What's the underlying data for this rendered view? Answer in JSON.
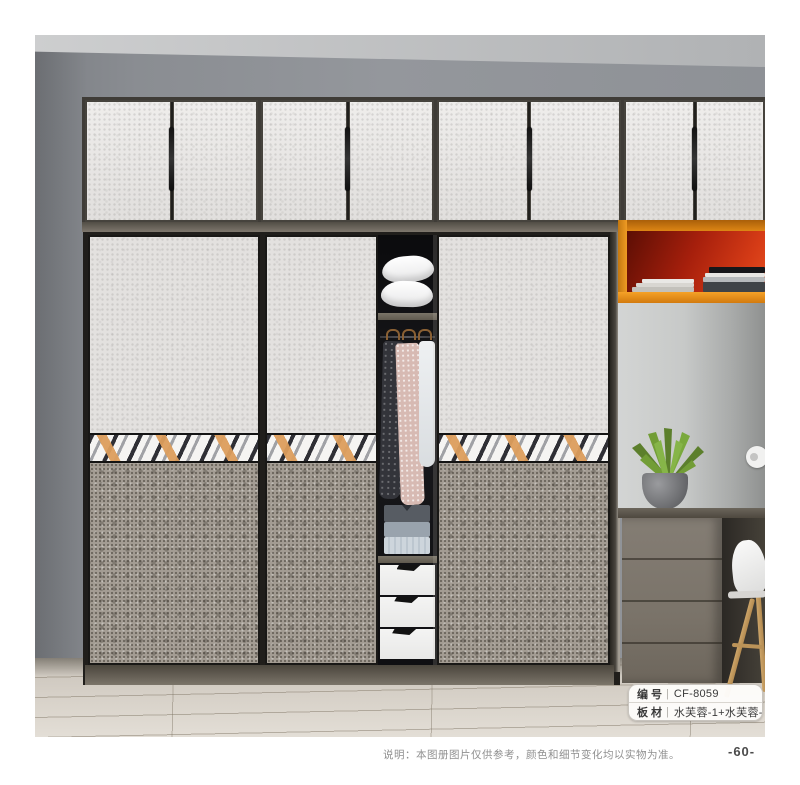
{
  "badges": {
    "separator": "|",
    "rows": [
      {
        "label": "编号",
        "value": "CF-8059"
      },
      {
        "label": "板材",
        "value": "水芙蓉-1+水芙蓉-3"
      }
    ]
  },
  "footer": {
    "disclaimer": "说明：本图册图片仅供参考，颜色和细节变化均以实物为准。",
    "page_number": "-60-"
  },
  "palette": {
    "accent_orange": "#e8901e",
    "niche_red": "#c2270f",
    "deco_strip_orange": "#dd9e5c",
    "door_light_texture": "#e8e6e4",
    "door_dark_texture": "#a39c93",
    "wall_gray": "#8d9095"
  }
}
